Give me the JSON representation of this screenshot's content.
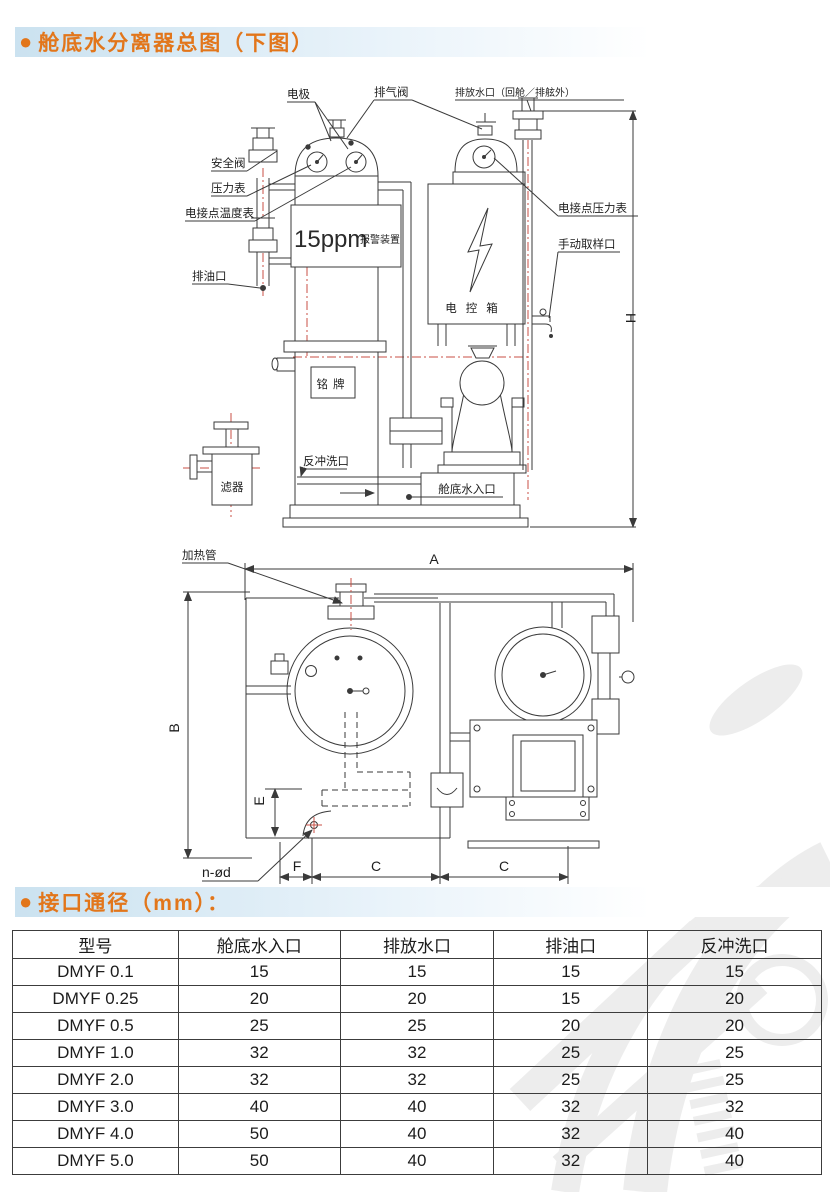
{
  "page": {
    "bullet": "●",
    "section1_title": "舱底水分离器总图（下图）",
    "section2_title": "接口通径（mm）："
  },
  "diagram_side": {
    "labels": {
      "electrode": "电极",
      "vent_valve": "排气阀",
      "discharge_outlet": "排放水口（回舱／排舷外）",
      "safety_valve": "安全阀",
      "pressure_gauge": "压力表",
      "contact_thermometer": "电接点温度表",
      "oil_outlet": "排油口",
      "ppm_value": "15ppm",
      "ppm_device": "报警装置",
      "contact_pressure_gauge": "电接点压力表",
      "manual_sample_port": "手动取样口",
      "control_box": "电控箱",
      "nameplate": "铭牌",
      "filter": "滤器",
      "backflush_port": "反冲洗口",
      "bilge_water_inlet": "舱底水入口",
      "dim_h": "H"
    }
  },
  "diagram_top": {
    "labels": {
      "heating_tube": "加热管",
      "dim_a": "A",
      "dim_b": "B",
      "dim_e": "E",
      "dim_f": "F",
      "dim_c1": "C",
      "dim_c2": "C",
      "bolt_holes": "n-ød"
    }
  },
  "table": {
    "headers": [
      "型号",
      "舱底水入口",
      "排放水口",
      "排油口",
      "反冲洗口"
    ],
    "rows": [
      [
        "DMYF 0.1",
        "15",
        "15",
        "15",
        "15"
      ],
      [
        "DMYF 0.25",
        "20",
        "20",
        "15",
        "20"
      ],
      [
        "DMYF 0.5",
        "25",
        "25",
        "20",
        "20"
      ],
      [
        "DMYF 1.0",
        "32",
        "32",
        "25",
        "25"
      ],
      [
        "DMYF 2.0",
        "32",
        "32",
        "25",
        "25"
      ],
      [
        "DMYF 3.0",
        "40",
        "40",
        "32",
        "32"
      ],
      [
        "DMYF 4.0",
        "50",
        "40",
        "32",
        "40"
      ],
      [
        "DMYF 5.0",
        "50",
        "40",
        "32",
        "40"
      ]
    ]
  },
  "colors": {
    "accent_orange": "#e2761b",
    "band_blue": "#cbe2f0",
    "centerline_red": "#c94f44",
    "line_gray": "#3a3a3a"
  }
}
